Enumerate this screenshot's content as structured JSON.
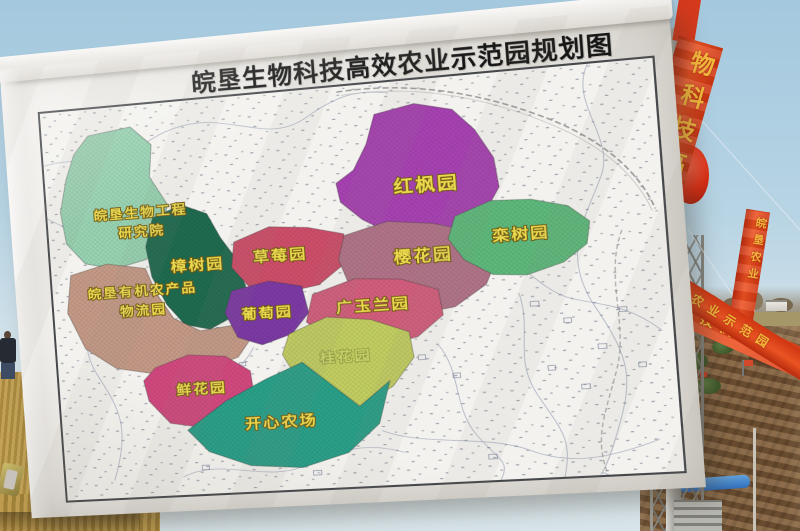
{
  "scene": {
    "sky_top": "#a4c8de",
    "sky_bottom": "#d8e5ea",
    "dirt_color": "#7a5a3a",
    "grass_color": "#b3924c",
    "banner_red": "#d63a1c",
    "banner_text_color": "#f2b73c",
    "lantern_color": "#d92c12"
  },
  "billboard": {
    "title": "皖垦生物科技高效农业示范园规划图",
    "canvas_color": "#ebe9e5",
    "map_label_color": "#ead94f"
  },
  "banners": {
    "main": "物科技高效农业",
    "small": "皖垦农业",
    "lower1": "生物科技高效农业",
    "lower2": "高效农业示范园"
  },
  "map": {
    "regions": [
      {
        "id": "research-institute",
        "name": "皖垦生物工程研究院",
        "color": "#98d3b2",
        "points": "48,30 92,24 112,46 108,82 124,114 116,150 99,174 66,182 36,174 18,150 14,114 22,78 32,50",
        "label": {
          "x": 96,
          "y": 126,
          "lines": [
            "皖垦生物工程",
            "研究院"
          ],
          "size": 14,
          "line_h": 21
        }
      },
      {
        "id": "camphor-garden",
        "name": "樟树园",
        "color": "#1f6b50",
        "points": "108,128 138,116 163,128 175,156 190,182 197,214 183,244 158,257 133,250 116,226 103,194 99,160",
        "label": {
          "x": 150,
          "y": 190,
          "lines": [
            "樟树园"
          ],
          "size": 16
        }
      },
      {
        "id": "logistics-park",
        "name": "皖垦有机农产品物流园",
        "color": "#c59a87",
        "points": "20,186 58,176 97,184 106,212 122,242 148,258 183,254 198,270 184,290 148,302 104,304 60,294 30,270 14,228",
        "label": {
          "x": 92,
          "y": 214,
          "lines": [
            "皖垦有机农产品",
            "物流园"
          ],
          "size": 14,
          "line_h": 22
        }
      },
      {
        "id": "red-maple-garden",
        "name": "红枫园",
        "color": "#a742b2",
        "points": "335,34 374,26 410,36 430,60 446,92 449,124 432,154 405,170 372,174 343,166 316,148 296,127 293,106 311,93 325,66",
        "label": {
          "x": 380,
          "y": 122,
          "lines": [
            "红枫园"
          ],
          "size": 19
        }
      },
      {
        "id": "strawberry-garden",
        "name": "草莓园",
        "color": "#ce4e6a",
        "points": "188,162 224,148 262,152 297,162 294,196 269,216 234,222 201,214 184,190",
        "label": {
          "x": 233,
          "y": 186,
          "lines": [
            "草莓园"
          ],
          "size": 16
        }
      },
      {
        "id": "grape-garden",
        "name": "葡萄园",
        "color": "#7c3aa4",
        "points": "182,216 220,208 252,216 257,246 239,268 209,278 185,268 174,240",
        "label": {
          "x": 216,
          "y": 248,
          "lines": [
            "葡萄园"
          ],
          "size": 15
        }
      },
      {
        "id": "cherry-blossom-garden",
        "name": "樱花园",
        "color": "#b17388",
        "points": "297,164 340,152 384,158 428,172 443,198 430,228 399,250 359,256 324,246 299,220 290,190",
        "label": {
          "x": 372,
          "y": 198,
          "lines": [
            "樱花园"
          ],
          "size": 17
        }
      },
      {
        "id": "luan-tree-garden",
        "name": "栾树园",
        "color": "#5eb97c",
        "points": "405,152 440,138 478,140 512,150 531,168 527,192 504,210 469,221 437,218 411,200 397,176",
        "label": {
          "x": 466,
          "y": 182,
          "lines": [
            "栾树园"
          ],
          "size": 16
        }
      },
      {
        "id": "magnolia-garden",
        "name": "广玉兰园",
        "color": "#d35e7d",
        "points": "262,226 304,212 349,216 384,230 387,258 361,280 319,289 279,281 254,256",
        "label": {
          "x": 320,
          "y": 248,
          "lines": [
            "广玉兰园"
          ],
          "size": 16
        }
      },
      {
        "id": "osmanthus-garden",
        "name": "桂花园",
        "color": "#c2ce61",
        "points": "236,268 274,252 317,258 353,274 356,302 334,332 299,354 264,346 240,316 228,290",
        "label": {
          "x": 290,
          "y": 302,
          "lines": [
            "桂花园"
          ],
          "size": 15,
          "faint": true
        }
      },
      {
        "id": "flower-garden",
        "name": "鲜花园",
        "color": "#d2497f",
        "points": "100,296 134,284 171,288 195,306 197,333 177,356 144,366 111,359 91,333 87,310",
        "label": {
          "x": 145,
          "y": 328,
          "lines": [
            "鲜花园"
          ],
          "size": 15
        }
      },
      {
        "id": "happy-farm",
        "name": "开心农场",
        "color": "#2aa089",
        "points": "128,368 168,338 210,316 247,300 300,352 331,326 318,372 286,402 240,416 189,411 148,393",
        "label": {
          "x": 222,
          "y": 370,
          "lines": [
            "开心农场"
          ],
          "size": 16
        }
      }
    ]
  }
}
